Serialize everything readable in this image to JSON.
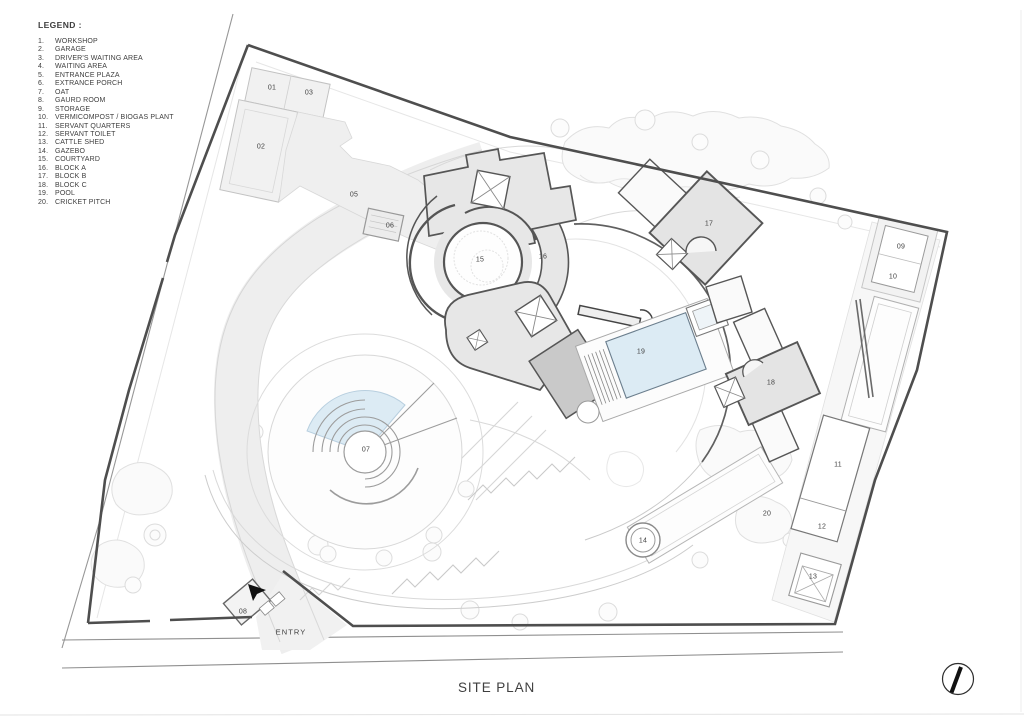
{
  "sheet": {
    "title": "SITE PLAN"
  },
  "legend": {
    "title": "LEGEND :",
    "items": [
      {
        "num": "1.",
        "label": "WORKSHOP"
      },
      {
        "num": "2.",
        "label": "GARAGE"
      },
      {
        "num": "3.",
        "label": "DRIVER'S WAITING AREA"
      },
      {
        "num": "4.",
        "label": "WAITING AREA"
      },
      {
        "num": "5.",
        "label": "ENTRANCE PLAZA"
      },
      {
        "num": "6.",
        "label": "EXTRANCE PORCH"
      },
      {
        "num": "7.",
        "label": "OAT"
      },
      {
        "num": "8.",
        "label": "GAURD ROOM"
      },
      {
        "num": "9.",
        "label": "STORAGE"
      },
      {
        "num": "10.",
        "label": "VERMICOMPOST / BIOGAS PLANT"
      },
      {
        "num": "11.",
        "label": "SERVANT QUARTERS"
      },
      {
        "num": "12.",
        "label": "SERVANT TOILET"
      },
      {
        "num": "13.",
        "label": "CATTLE SHED"
      },
      {
        "num": "14.",
        "label": "GAZEBO"
      },
      {
        "num": "15.",
        "label": "COURTYARD"
      },
      {
        "num": "16.",
        "label": "BLOCK A"
      },
      {
        "num": "17.",
        "label": "BLOCK B"
      },
      {
        "num": "18.",
        "label": "BLOCK C"
      },
      {
        "num": "19.",
        "label": "POOL"
      },
      {
        "num": "20.",
        "label": "CRICKET PITCH"
      }
    ]
  },
  "plan": {
    "entry_label": "ENTRY",
    "labels": [
      {
        "id": "01",
        "x": 272,
        "y": 88
      },
      {
        "id": "03",
        "x": 309,
        "y": 93
      },
      {
        "id": "02",
        "x": 261,
        "y": 147
      },
      {
        "id": "05",
        "x": 354,
        "y": 195
      },
      {
        "id": "06",
        "x": 390,
        "y": 226
      },
      {
        "id": "15",
        "x": 480,
        "y": 260
      },
      {
        "id": "16",
        "x": 543,
        "y": 257
      },
      {
        "id": "17",
        "x": 709,
        "y": 224
      },
      {
        "id": "18",
        "x": 771,
        "y": 383
      },
      {
        "id": "19",
        "x": 641,
        "y": 352
      },
      {
        "id": "07",
        "x": 366,
        "y": 450
      },
      {
        "id": "08",
        "x": 243,
        "y": 612
      },
      {
        "id": "09",
        "x": 901,
        "y": 247
      },
      {
        "id": "10",
        "x": 893,
        "y": 277
      },
      {
        "id": "11",
        "x": 838,
        "y": 465
      },
      {
        "id": "12",
        "x": 822,
        "y": 527
      },
      {
        "id": "13",
        "x": 813,
        "y": 577
      },
      {
        "id": "14",
        "x": 643,
        "y": 541
      },
      {
        "id": "20",
        "x": 767,
        "y": 514
      }
    ]
  },
  "colors": {
    "boundary": "#4e4e4e",
    "building_fill": "#e7e7e7",
    "building_stroke": "#565656",
    "secondary_fill": "#c9c9c9",
    "pool_fill": "#dcebf4",
    "landscape_stroke": "#e0e0e0",
    "text": "#3e3e3e"
  }
}
